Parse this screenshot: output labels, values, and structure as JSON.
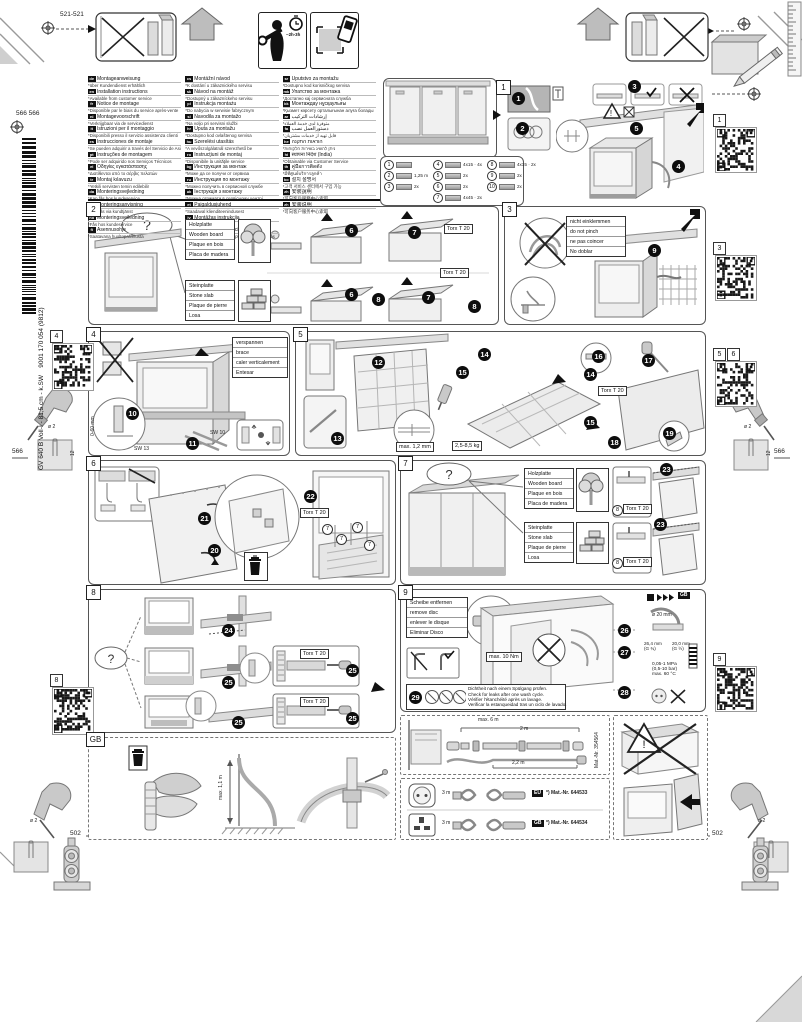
{
  "page": {
    "model": "GV 640 B VolI-I - 81,5 cm - k.SW",
    "doc_number": "9001 170 054 (9812)"
  },
  "top": {
    "dim_left": "521-521",
    "time": "~2h-3h"
  },
  "sidebar_left": {
    "dim_top": "566 566",
    "dim_mid": "566",
    "dim_bottom": "502",
    "qr4_label": "4",
    "qr8_label": "8",
    "drill_dia": "ø 2",
    "drill_depth": "12"
  },
  "sidebar_right": {
    "qr1_label": "1",
    "qr3_label": "3",
    "qr5_label": "5",
    "qr6_label": "6",
    "qr9_label": "9",
    "dim_mid": "566",
    "dim_bottom": "502",
    "drill_dia": "ø 2",
    "drill_depth": "12"
  },
  "languages": {
    "columns": [
      [
        {
          "c": "de",
          "t": "Montageanweisung",
          "n": "*über Kundendienst erhältlich"
        },
        {
          "c": "en",
          "t": "Installation instructions",
          "n": "*Available from customer service"
        },
        {
          "c": "fr",
          "t": "Notice de montage",
          "n": "*Disponible par le biais du service après-vente"
        },
        {
          "c": "nl",
          "t": "Montagevoorschrift",
          "n": "*Verkrijgbaar via de servicedienst"
        },
        {
          "c": "it",
          "t": "Istruzioni per il montaggio",
          "n": "*Disponibili presso il servizio assistenza clienti"
        },
        {
          "c": "es",
          "t": "Instrucciones de montaje",
          "n": "*Se pueden adquirir a través del Servicio de Asistencia Técnica"
        },
        {
          "c": "pt",
          "t": "Instruções de montagem",
          "n": "*Pode ser adquirido nos Serviços Técnicos"
        },
        {
          "c": "el",
          "t": "Οδηγίες εγκατάστασης",
          "n": "*Διατίθενται από το σέρβις πελατών"
        },
        {
          "c": "tr",
          "t": "Montaj kılavuzu",
          "n": "*Yetkili servisten temin edilebilir"
        },
        {
          "c": "da",
          "t": "Monteringsvejledning",
          "n": "*Kan fås hos kundeservice"
        },
        {
          "c": "sv",
          "t": "Monteringsanvisning",
          "n": "*Kan fås via kundtjänst"
        },
        {
          "c": "no",
          "t": "Monteringsveiledning",
          "n": "*Fås hos kundeservice"
        },
        {
          "c": "fi",
          "t": "Asennusohje",
          "n": "*Saatavana huoltopalvelusta"
        }
      ],
      [
        {
          "c": "cs",
          "t": "Montážní návod",
          "n": "*K dostání u zákaznického servisu"
        },
        {
          "c": "sk",
          "t": "Návod na montáž",
          "n": "*Dostupný u zákazníckeho servisu"
        },
        {
          "c": "pl",
          "t": "Instrukcja montażu",
          "n": "*Do nabycia w serwisie fabrycznym"
        },
        {
          "c": "sl",
          "t": "Navodila za montažo",
          "n": "*Na voljo pri servisni službi"
        },
        {
          "c": "hr",
          "t": "Uputa za montažu",
          "n": "*Dostupno kod ovlaštenog servisa"
        },
        {
          "c": "hu",
          "t": "Szerelési utasítás",
          "n": "*A vevőszolgálatnál szerezhető be"
        },
        {
          "c": "ro",
          "t": "Instrucţiuni de montaj",
          "n": "*Disponibile la unităţile service"
        },
        {
          "c": "bg",
          "t": "Инструкция за монтаж",
          "n": "*Може да се получи от сервиза"
        },
        {
          "c": "ru",
          "t": "Инструкция по монтажу",
          "n": "*Можно получить в сервисной службе"
        },
        {
          "c": "uk",
          "t": "Інструкція з монтажу",
          "n": "*Можна отримати в сервісному центрі"
        },
        {
          "c": "et",
          "t": "Paigaldusjuhend",
          "n": "*Saadaval klienditeenindusest"
        },
        {
          "c": "lv",
          "t": "Montāžas instrukcija",
          "n": "*Pieejama klientu servisā"
        },
        {
          "c": "lt",
          "t": "Montavimo instrukcija",
          "n": "*Galima įsigyti iš klientų aptarnavimo tarnybos"
        }
      ],
      [
        {
          "c": "sr",
          "t": "Uputstvo za montažu",
          "n": "*Dostupno kod korisničkog servisa"
        },
        {
          "c": "mk",
          "t": "Упатство за монтажа",
          "n": "*Достапно кај сервисната служба"
        },
        {
          "c": "kk",
          "t": "Монтаждау нұсқаулығы",
          "n": "*Қызмет көрсету орталығынан алуға болады"
        },
        {
          "c": "ar",
          "t": "إرشادات التركيب",
          "n": "*متوفرة لدى خدمة العملاء"
        },
        {
          "c": "fa",
          "t": "دستورالعمل نصب",
          "n": "*قابل تهیه از خدمات مشتریان"
        },
        {
          "c": "he",
          "t": "הוראות התקנה",
          "n": "*ניתן להשיג בשירות הלקוחות"
        },
        {
          "c": "hi",
          "t": "स्थापना निर्देश (India)",
          "n": "*Obtainable via Customer Service"
        },
        {
          "c": "th",
          "t": "คู่มือการติดตั้ง",
          "n": "*มีที่ศูนย์บริการลูกค้า"
        },
        {
          "c": "ko",
          "t": "설치 설명서",
          "n": "*고객 서비스 센터에서 구입 가능"
        },
        {
          "c": "zh",
          "t": "安裝說明",
          "n": "*可向客戶服務中心索取"
        },
        {
          "c": "zh",
          "t": "安装说明",
          "n": "*可向客户服务中心索取"
        }
      ]
    ]
  },
  "panel1": {
    "num": "1",
    "steps": [
      "1",
      "2",
      "3",
      "4",
      "5"
    ],
    "parts": [
      {
        "no": "1",
        "qty": ""
      },
      {
        "no": "2",
        "qty": "1,25 m"
      },
      {
        "no": "3",
        "qty": "2x"
      },
      {
        "no": "4",
        "qty": "4x15 · 4x"
      },
      {
        "no": "5",
        "qty": "2x"
      },
      {
        "no": "6",
        "qty": "2x"
      },
      {
        "no": "7",
        "qty": "4x45 · 2x"
      },
      {
        "no": "8",
        "qty": "4x15 · 2x"
      },
      {
        "no": "9",
        "qty": "2x"
      },
      {
        "no": "10",
        "qty": "2x"
      }
    ]
  },
  "panel2": {
    "num": "2",
    "wood": [
      "Holzplatte",
      "Wooden board",
      "Plaque en bois",
      "Placa de madera"
    ],
    "stone": [
      "Steinplatte",
      "Stone slab",
      "Plaque de pierre",
      "Losa"
    ],
    "torx": "Torx T 20",
    "steps": [
      "6",
      "7",
      "6",
      "7",
      "8",
      "8"
    ]
  },
  "panel3": {
    "num": "3",
    "warning": [
      "nicht einklemmen",
      "do not pinch",
      "ne pas coincer",
      "No doblar"
    ],
    "step": "9"
  },
  "panel4": {
    "num": "4",
    "labels": [
      "verspannen",
      "brace",
      "caler verticalement",
      "Entesar"
    ],
    "range": "0-60 mm",
    "sw13": "SW 13",
    "sw10": "SW 10",
    "steps": [
      "10",
      "11"
    ]
  },
  "panel5": {
    "num": "5",
    "steps": [
      "12",
      "13",
      "14",
      "15",
      "14",
      "15",
      "16",
      "17",
      "18",
      "19"
    ],
    "gap": "max. 1,2 mm",
    "weight": "2,5-8,5 kg",
    "torx": "Torx T 20"
  },
  "panel6": {
    "num": "6",
    "steps": [
      "20",
      "21",
      "22"
    ],
    "torx": "Torx T 20",
    "part_ref": "7"
  },
  "panel7": {
    "num": "7",
    "wood": [
      "Holzplatte",
      "Wooden board",
      "Plaque en bois",
      "Placa de madera"
    ],
    "stone": [
      "Steinplatte",
      "Stone slab",
      "Plaque de pierre",
      "Losa"
    ],
    "torx": "Torx T 20",
    "part_ref": "8",
    "steps": [
      "23",
      "23"
    ]
  },
  "panel8": {
    "num": "8",
    "steps": [
      "24",
      "25",
      "25",
      "25",
      "25"
    ],
    "torx": "Torx T 20"
  },
  "panel9": {
    "num": "9",
    "disc": [
      "Scheibe entfernen",
      "remove disc",
      "enlever le disque",
      "Eliminar Disco"
    ],
    "torque": "max. 10 Nm",
    "steps": [
      "26",
      "27",
      "28",
      "29"
    ],
    "leak": [
      "Dichtheit nach einem Spülgang prüfen.",
      "Check for leaks after one wash cycle.",
      "Vérifier l'étanchéité après un lavage.",
      "Verificar la estanqueidad tras un ciclo de lavado."
    ],
    "gb_ref": "GB",
    "specs": {
      "dia": "ø 20 mm",
      "c34a": "26,4 mm",
      "c34b": "(G ¾)",
      "c12a": "20,0 mm",
      "c12b": "(G ½)",
      "p1": "0,05-1 MPa",
      "p2": "(0,5-10 bar)",
      "t": "max. 60 °C"
    }
  },
  "gb_panel": {
    "num": "GB",
    "height": "max. 1,1 m"
  },
  "hose_panel": {
    "max": "max. 6 m",
    "l1": "2 m",
    "l2": "2,2 m",
    "mat": "Mat.-Nr. 354564"
  },
  "cords_panel": {
    "rows": [
      {
        "len": "3 m",
        "chip": "EU",
        "mat": "*) Mat.-Nr. 644533"
      },
      {
        "len": "3 m",
        "chip": "GB",
        "mat": "*) Mat.-Nr. 644534"
      }
    ]
  }
}
